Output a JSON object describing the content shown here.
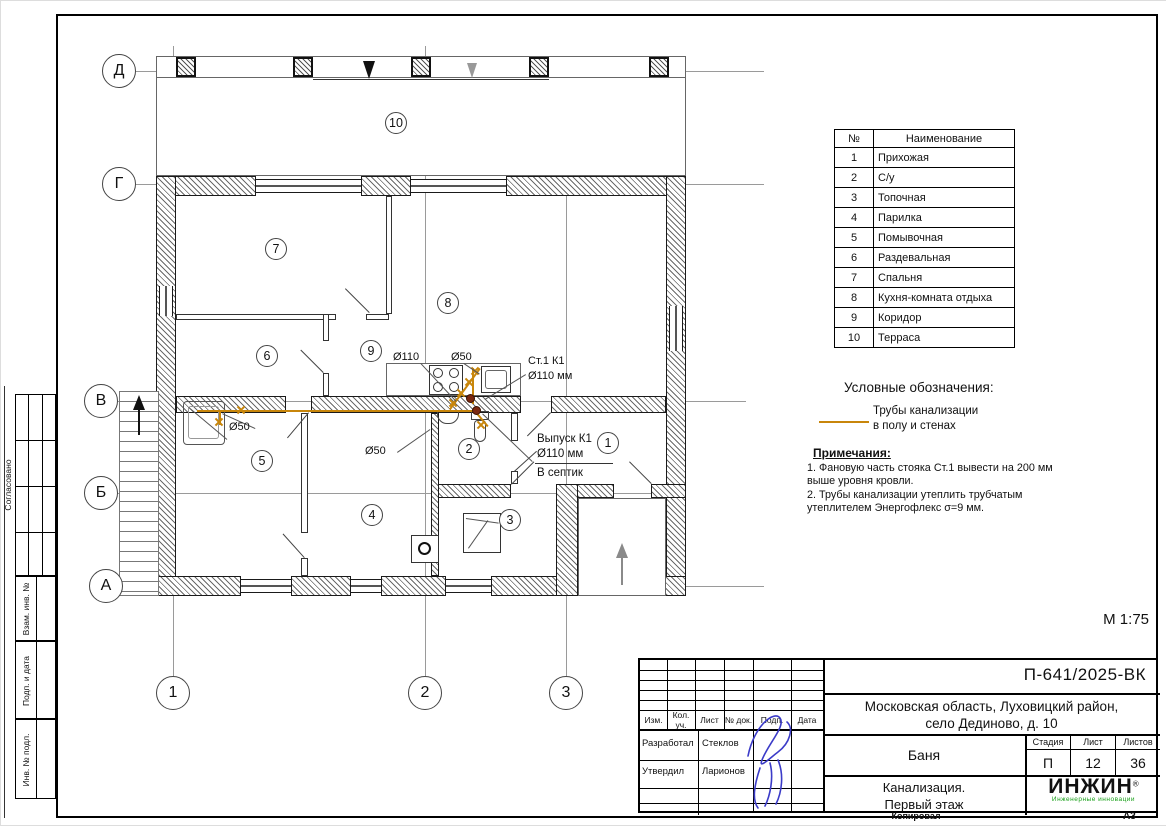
{
  "axes": {
    "horizontal": [
      "Д",
      "Г",
      "В",
      "Б",
      "А"
    ],
    "vertical": [
      "1",
      "2",
      "3"
    ]
  },
  "rooms_table": {
    "headers": [
      "№",
      "Наименование"
    ],
    "rows": [
      [
        "1",
        "Прихожая"
      ],
      [
        "2",
        "С/у"
      ],
      [
        "3",
        "Топочная"
      ],
      [
        "4",
        "Парилка"
      ],
      [
        "5",
        "Помывочная"
      ],
      [
        "6",
        "Раздевальная"
      ],
      [
        "7",
        "Спальня"
      ],
      [
        "8",
        "Кухня-комната отдыха"
      ],
      [
        "9",
        "Коридор"
      ],
      [
        "10",
        "Терраса"
      ]
    ]
  },
  "legend": {
    "title": "Условные обозначения:",
    "pipe_label": "Трубы канализации\nв полу и стенах"
  },
  "notes": {
    "title": "Примечания:",
    "items": [
      "1.   Фановую часть стояка Ст.1  вывести на 200 мм выше уровня кровли.",
      "2.   Трубы канализации утеплить трубчатым утеплителем Энергофлекс σ=9 мм."
    ]
  },
  "plan": {
    "scale": "М 1:75",
    "labels": {
      "riser_d110": "Ø110",
      "riser_d50": "Ø50",
      "st1_line1": "Ст.1  К1",
      "st1_line2": "Ø110 мм",
      "outlet_line1": "Выпуск К1",
      "outlet_line2": "Ø110 мм",
      "outlet_line3": "В септик",
      "shower_d50": "Ø50",
      "parilka_d50": "Ø50"
    }
  },
  "side_strip": {
    "approved": "Согласовано",
    "boxes": [
      "Взам. инв. №",
      "Подп. и дата",
      "Инв. № подл."
    ]
  },
  "title_block": {
    "doc_number": "П-641/2025-ВК",
    "address": "Московская область, Луховицкий район,\nсело Дединово, д. 10",
    "object_name": "Баня",
    "stage_label": "Стадия",
    "sheet_label": "Лист",
    "sheets_label": "Листов",
    "stage": "П",
    "sheet_no": "12",
    "sheets_total": "36",
    "drawing_name": "Канализация.\nПервый этаж",
    "columns": [
      "Изм.",
      "Кол. уч.",
      "Лист",
      "№ док.",
      "Подп.",
      "Дата"
    ],
    "developed_label": "Разработал",
    "developed_name": "Стеклов",
    "approved_label": "Утвердил",
    "approved_name": "Ларионов",
    "logo_text": "ИНЖИН",
    "logo_reg": "®",
    "logo_subtitle": "Инженерные инновации",
    "copied_label": "Копировал",
    "format_label": "А3"
  },
  "colors": {
    "pipe": "#C8860B",
    "stack_dot": "#7A2810",
    "signature_blue": "#3B3BC8",
    "logo_green": "#18A018"
  }
}
